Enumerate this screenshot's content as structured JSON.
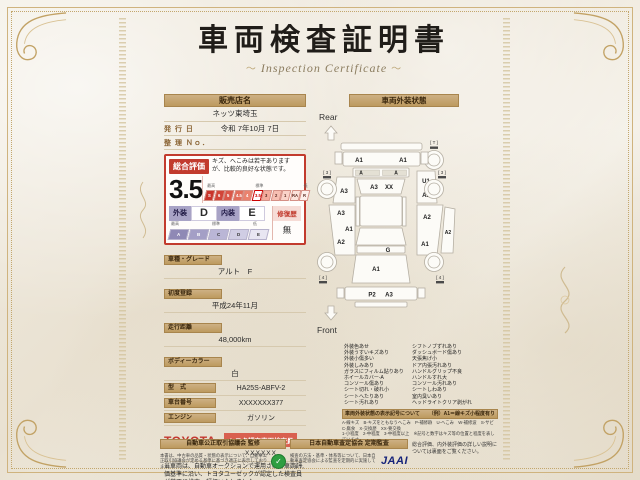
{
  "title": {
    "main": "車両検査証明書",
    "sub": "Inspection Certificate",
    "orn_left": "～",
    "orn_right": "～"
  },
  "dealer": {
    "shop_label": "販売店名",
    "shop_name": "ネッツ東埼玉",
    "issue_label": "発 行 日",
    "issue_value": "令和 7年10月 7日",
    "ref_label": "整 理 Ｎｏ．",
    "ref_value": ""
  },
  "rating": {
    "header": "総合評価",
    "comment": "キズ、へこみは若干ありますが、比較的良好な状態です。",
    "score": "3.5",
    "scale_high": "最高",
    "scale_mid": "標準",
    "scale_low": "低",
    "score_scale": [
      "S",
      "6",
      "5",
      "4.5",
      "4",
      "3.5",
      "3",
      "2",
      "1",
      "RA",
      "R"
    ],
    "exterior_label": "外装",
    "exterior_grade": "D",
    "interior_label": "内装",
    "interior_grade": "E",
    "grade_scale": [
      "A",
      "B",
      "C",
      "D",
      "E"
    ],
    "repair_label": "修復歴",
    "repair_value": "無"
  },
  "vehicle": {
    "model_label": "車種・グレード",
    "model": "アルト　F",
    "first_reg_label": "初度登録",
    "first_reg": "平成24年11月",
    "mileage_label": "走行距離",
    "mileage": "48,000km",
    "color_label": "ボディーカラー",
    "color": "白",
    "type_label": "型　式",
    "type": "HA25S-ABFV-2",
    "chassis_label": "車台番号",
    "chassis": "XXXXXXX377",
    "engine_label": "エンジン",
    "engine": "ガソリン"
  },
  "inspector": {
    "brand": "TOYOTA",
    "badge": "トヨタ認定車両検査員",
    "id": "XXXXXX",
    "disclaimer": "当車両は、自動車オークションで運用される車両評価基準に沿い、トヨタユーゼックが認定した検査員が厳正に検査・評価いたしました。"
  },
  "exterior": {
    "header": "車両外装状態",
    "diagram": {
      "rear_text": "Rear",
      "front_text": "Front",
      "rear_bumper_left": "A1",
      "rear_bumper_right": "A1",
      "rear_trim_left": "A",
      "rear_trim_right": "A",
      "rear_glass_left": "A3",
      "rear_glass_right": "XX",
      "left_fender": "A3",
      "left_door_top": "A3",
      "left_door_mid": "A1",
      "left_door_bottom": "A2",
      "right_quarter_top": "U1",
      "right_quarter_bottom": "A2",
      "right_door_top": "A2",
      "right_door_bottom": "A1",
      "right_outer": "A2",
      "cowl": "G",
      "hood": "A1",
      "front_bumper_left": "P2",
      "front_bumper_right": "A3",
      "spare_tire": "[ T ]",
      "tire_rear_left": "[ 3 ]",
      "tire_rear_right": "[ 3 ]",
      "tire_front_left": "[ 4 ]",
      "tire_front_right": "[ 4 ]"
    },
    "legend_left": [
      "外装色あせ",
      "外装うすいキズあり",
      "外装小傷多い",
      "外装しみあり",
      "ガラスにフィルム貼りあり",
      "ホイールカバー-A",
      "コンソール傷あり",
      "シート切れ・破れ小",
      "シートへたりあり",
      "シート汚れあり"
    ],
    "legend_right": [
      "シフトノブずれあり",
      "ダッシュボード傷あり",
      "天張焦げ小",
      "ドア内張汚れあり",
      "ハンドルグリップ不良",
      "ハンドルすれ大",
      "コンソール汚れあり",
      "シートしわあり",
      "室内臭いあり",
      "ヘッドライトクリア剥がれ"
    ],
    "codes_title": "車両外装状態の表示記号について",
    "codes_example": "（例）A1＝線キズ小程度有り",
    "codes_lines": [
      "A-線キズ　B-キズをともなうへこみ　P-補修跡　U-へこみ　W-補修波　S-サビ　C-腐食　X-交換歴　XX-要交換",
      "1-小程度　2-中程度　3-中程度以上　※記号と数字はキズ等の位置と程度を表しています。"
    ]
  },
  "footer": {
    "fair_trade_title": "自動車公正取引協議会 監修",
    "fair_trade_text": "本書は、中古車の品質・状態の表示について、自動車公正取引協議会が定める基準に基づき適正に表示しております。",
    "jaai_title": "日本自動車査定協会 定期監査",
    "jaai_text": "検査の方法・基準・体系等について、日本自動車査定協会による監査を定期的に実施しています。",
    "jaai_logo": "JAAI",
    "note": "総合評価、内外装評価の詳しい説明については裏面をご覧ください。"
  }
}
